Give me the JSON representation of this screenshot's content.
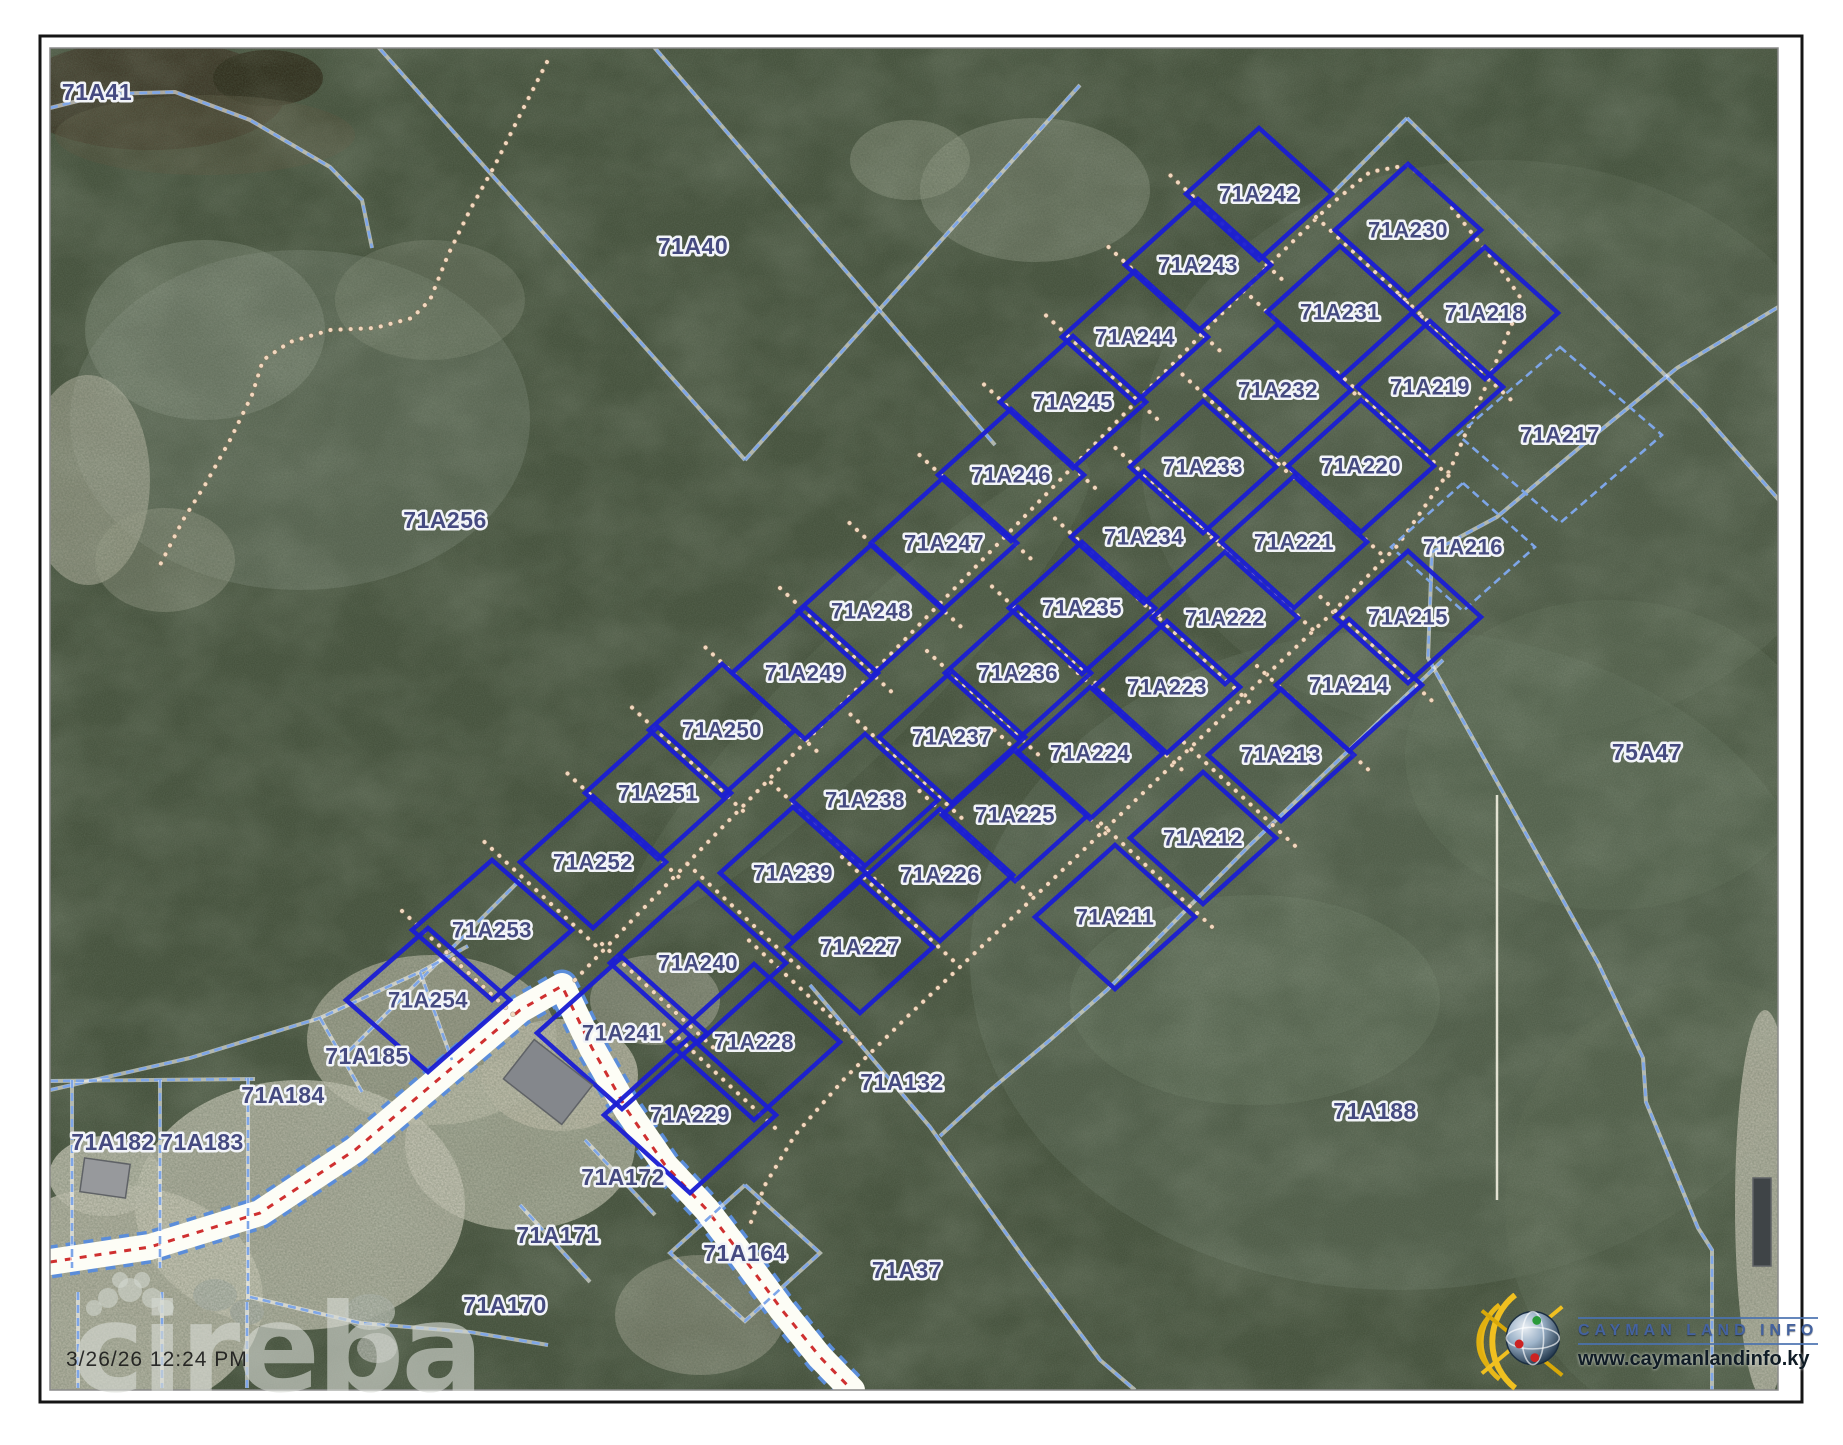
{
  "document": {
    "type": "cadastral-parcel-map-print",
    "timestamp": "3/26/26 12:24 PM",
    "watermark": "cireba",
    "logo": {
      "title": "CAYMAN LAND INFO",
      "url": "www.caymanlandinfo.ky"
    }
  },
  "colors": {
    "parcel_bold": "#1b1ed2",
    "parcel_light": "#7ea6e8",
    "label": "#454a80",
    "label_halo": "#f2f4f8",
    "trail_dots": "#f2d8bf",
    "trail_shadow": "#8a7258",
    "road_white": "#fdfdf6",
    "road_center_red": "#cf3030",
    "veg_base": "#45513c",
    "frame_dark": "#151515",
    "frame_gray": "#8a8a8a"
  },
  "frame": {
    "outer": [
      40,
      36,
      1762,
      1366
    ],
    "map": [
      50,
      48,
      1728,
      1342
    ]
  },
  "lot_geometry": {
    "half_w": 73,
    "half_h": 66
  },
  "lots_bold": [
    {
      "id": "71A242",
      "x": 1259,
      "y": 194
    },
    {
      "id": "71A243",
      "x": 1198,
      "y": 265
    },
    {
      "id": "71A244",
      "x": 1135,
      "y": 337
    },
    {
      "id": "71A245",
      "x": 1073,
      "y": 402
    },
    {
      "id": "71A246",
      "x": 1011,
      "y": 475
    },
    {
      "id": "71A247",
      "x": 944,
      "y": 543
    },
    {
      "id": "71A248",
      "x": 871,
      "y": 611
    },
    {
      "id": "71A249",
      "x": 805,
      "y": 673
    },
    {
      "id": "71A250",
      "x": 722,
      "y": 730
    },
    {
      "id": "71A251",
      "x": 658,
      "y": 793
    },
    {
      "id": "71A252",
      "x": 593,
      "y": 862
    },
    {
      "id": "71A253",
      "x": 492,
      "y": 930,
      "dh": 80,
      "dv": 70
    },
    {
      "id": "71A254",
      "x": 428,
      "y": 1000,
      "dh": 82,
      "dv": 72
    },
    {
      "id": "71A230",
      "x": 1408,
      "y": 230
    },
    {
      "id": "71A231",
      "x": 1340,
      "y": 312
    },
    {
      "id": "71A232",
      "x": 1278,
      "y": 390
    },
    {
      "id": "71A233",
      "x": 1203,
      "y": 467
    },
    {
      "id": "71A234",
      "x": 1144,
      "y": 537
    },
    {
      "id": "71A235",
      "x": 1082,
      "y": 608
    },
    {
      "id": "71A236",
      "x": 1018,
      "y": 673
    },
    {
      "id": "71A237",
      "x": 952,
      "y": 737
    },
    {
      "id": "71A238",
      "x": 865,
      "y": 800
    },
    {
      "id": "71A239",
      "x": 793,
      "y": 873
    },
    {
      "id": "71A240",
      "x": 698,
      "y": 963,
      "dh": 88,
      "dv": 80
    },
    {
      "id": "71A241",
      "x": 622,
      "y": 1033,
      "dh": 85,
      "dv": 76
    },
    {
      "id": "71A218",
      "x": 1485,
      "y": 313
    },
    {
      "id": "71A219",
      "x": 1430,
      "y": 387
    },
    {
      "id": "71A220",
      "x": 1361,
      "y": 466
    },
    {
      "id": "71A221",
      "x": 1294,
      "y": 542
    },
    {
      "id": "71A222",
      "x": 1225,
      "y": 618
    },
    {
      "id": "71A223",
      "x": 1167,
      "y": 687
    },
    {
      "id": "71A224",
      "x": 1090,
      "y": 753
    },
    {
      "id": "71A225",
      "x": 1015,
      "y": 815
    },
    {
      "id": "71A226",
      "x": 940,
      "y": 875
    },
    {
      "id": "71A227",
      "x": 860,
      "y": 947
    },
    {
      "id": "71A228",
      "x": 754,
      "y": 1042,
      "dh": 86,
      "dv": 78
    },
    {
      "id": "71A229",
      "x": 690,
      "y": 1115,
      "dh": 86,
      "dv": 78
    },
    {
      "id": "71A211",
      "x": 1115,
      "y": 917,
      "dh": 80,
      "dv": 72
    },
    {
      "id": "71A212",
      "x": 1203,
      "y": 838
    },
    {
      "id": "71A213",
      "x": 1281,
      "y": 755
    },
    {
      "id": "71A214",
      "x": 1349,
      "y": 685
    },
    {
      "id": "71A215",
      "x": 1408,
      "y": 617
    }
  ],
  "lots_light": [
    {
      "id": "71A216",
      "x": 1463,
      "y": 547,
      "dh": 72,
      "dv": 64
    },
    {
      "id": "71A217",
      "x": 1560,
      "y": 435,
      "dh": 102,
      "dv": 88
    }
  ],
  "columns": [
    [
      "71A242",
      "71A243",
      "71A244",
      "71A245",
      "71A246",
      "71A247",
      "71A248",
      "71A249",
      "71A250",
      "71A251",
      "71A252",
      "71A253",
      "71A254"
    ],
    [
      "71A230",
      "71A231",
      "71A232",
      "71A233",
      "71A234",
      "71A235",
      "71A236",
      "71A237",
      "71A238",
      "71A239",
      "71A240",
      "71A241"
    ],
    [
      "71A218",
      "71A219",
      "71A220",
      "71A221",
      "71A222",
      "71A223",
      "71A224",
      "71A225",
      "71A226",
      "71A227",
      "71A228",
      "71A229"
    ],
    [
      "71A211",
      "71A212",
      "71A213",
      "71A214",
      "71A215"
    ]
  ],
  "area_labels": [
    {
      "text": "71A41",
      "x": 97,
      "y": 92
    },
    {
      "text": "71A40",
      "x": 693,
      "y": 246
    },
    {
      "text": "71A256",
      "x": 445,
      "y": 520
    },
    {
      "text": "75A47",
      "x": 1647,
      "y": 752
    },
    {
      "text": "71A188",
      "x": 1375,
      "y": 1111
    },
    {
      "text": "71A132",
      "x": 902,
      "y": 1082
    },
    {
      "text": "71A37",
      "x": 907,
      "y": 1270
    },
    {
      "text": "71A164",
      "x": 745,
      "y": 1253
    },
    {
      "text": "71A172",
      "x": 623,
      "y": 1177
    },
    {
      "text": "71A171",
      "x": 558,
      "y": 1235
    },
    {
      "text": "71A170",
      "x": 505,
      "y": 1305
    },
    {
      "text": "71A185",
      "x": 367,
      "y": 1056
    },
    {
      "text": "71A184",
      "x": 283,
      "y": 1095
    },
    {
      "text": "71A183",
      "x": 202,
      "y": 1142
    },
    {
      "text": "71A182",
      "x": 113,
      "y": 1142
    }
  ],
  "cadastral_lines": [
    {
      "name": "pond-shore",
      "pts": [
        [
          50,
          108
        ],
        [
          105,
          94
        ],
        [
          175,
          92
        ],
        [
          250,
          120
        ],
        [
          330,
          167
        ],
        [
          362,
          200
        ],
        [
          372,
          248
        ]
      ]
    },
    {
      "name": "parcel40-west",
      "pts": [
        [
          372,
          40
        ],
        [
          745,
          460
        ]
      ]
    },
    {
      "name": "parcel40-south",
      "pts": [
        [
          745,
          460
        ],
        [
          1080,
          85
        ]
      ]
    },
    {
      "name": "parcel40-east",
      "pts": [
        [
          648,
          40
        ],
        [
          995,
          445
        ]
      ]
    },
    {
      "name": "block-northwest",
      "pts": [
        [
          340,
          1060
        ],
        [
          520,
          880
        ]
      ]
    },
    {
      "name": "block-peak-left",
      "pts": [
        [
          1407,
          118
        ],
        [
          1330,
          196
        ]
      ]
    },
    {
      "name": "block-peak-right",
      "pts": [
        [
          1407,
          118
        ],
        [
          1513,
          223
        ],
        [
          1610,
          320
        ],
        [
          1700,
          410
        ],
        [
          1843,
          573
        ]
      ]
    },
    {
      "name": "east-boundary",
      "pts": [
        [
          1843,
          268
        ],
        [
          1677,
          368
        ],
        [
          1585,
          443
        ],
        [
          1497,
          517
        ],
        [
          1432,
          552
        ],
        [
          1428,
          658
        ],
        [
          1598,
          963
        ],
        [
          1643,
          1058
        ],
        [
          1646,
          1102
        ],
        [
          1698,
          1228
        ],
        [
          1712,
          1250
        ],
        [
          1712,
          1390
        ]
      ]
    },
    {
      "name": "block-southeast",
      "pts": [
        [
          1443,
          660
        ],
        [
          1250,
          845
        ],
        [
          1107,
          990
        ],
        [
          1050,
          1040
        ],
        [
          988,
          1092
        ],
        [
          940,
          1136
        ]
      ]
    },
    {
      "name": "road-corridor-ne",
      "pts": [
        [
          810,
          985
        ],
        [
          930,
          1127
        ],
        [
          1023,
          1257
        ],
        [
          1100,
          1360
        ],
        [
          1135,
          1390
        ]
      ]
    },
    {
      "name": "p184-top",
      "pts": [
        [
          50,
          1090
        ],
        [
          190,
          1058
        ],
        [
          320,
          1018
        ],
        [
          420,
          972
        ],
        [
          468,
          946
        ]
      ]
    },
    {
      "name": "p182-top",
      "pts": [
        [
          50,
          1081
        ],
        [
          255,
          1079
        ]
      ]
    },
    {
      "name": "tick-182a",
      "pts": [
        [
          72,
          1080
        ],
        [
          72,
          1268
        ]
      ]
    },
    {
      "name": "tick-182b",
      "pts": [
        [
          160,
          1080
        ],
        [
          160,
          1268
        ]
      ]
    },
    {
      "name": "tick-183",
      "pts": [
        [
          248,
          1078
        ],
        [
          248,
          1300
        ]
      ]
    },
    {
      "name": "tick-184",
      "pts": [
        [
          320,
          1018
        ],
        [
          362,
          1092
        ]
      ]
    },
    {
      "name": "tick-185",
      "pts": [
        [
          420,
          972
        ],
        [
          452,
          1060
        ]
      ]
    },
    {
      "name": "under-road-1",
      "pts": [
        [
          78,
          1292
        ],
        [
          78,
          1388
        ]
      ]
    },
    {
      "name": "under-road-2",
      "pts": [
        [
          162,
          1292
        ],
        [
          162,
          1388
        ]
      ]
    },
    {
      "name": "under-road-3",
      "pts": [
        [
          247,
          1302
        ],
        [
          247,
          1388
        ]
      ]
    },
    {
      "name": "under-road-4",
      "pts": [
        [
          250,
          1297
        ],
        [
          360,
          1323
        ],
        [
          470,
          1332
        ],
        [
          548,
          1345
        ]
      ]
    },
    {
      "name": "tick-171",
      "pts": [
        [
          585,
          1140
        ],
        [
          655,
          1215
        ]
      ]
    },
    {
      "name": "tick-170",
      "pts": [
        [
          520,
          1205
        ],
        [
          590,
          1282
        ]
      ]
    },
    {
      "name": "lot164-boundary",
      "pts": [
        [
          745,
          1185
        ],
        [
          820,
          1253
        ],
        [
          745,
          1321
        ],
        [
          670,
          1253
        ],
        [
          745,
          1185
        ]
      ]
    }
  ],
  "trails": [
    {
      "name": "northwest-trail",
      "pts": [
        [
          547,
          62
        ],
        [
          520,
          115
        ],
        [
          495,
          165
        ],
        [
          470,
          210
        ],
        [
          448,
          255
        ],
        [
          430,
          300
        ],
        [
          412,
          318
        ],
        [
          375,
          328
        ],
        [
          330,
          330
        ],
        [
          290,
          342
        ],
        [
          263,
          360
        ],
        [
          252,
          395
        ],
        [
          230,
          440
        ],
        [
          205,
          485
        ],
        [
          183,
          520
        ],
        [
          160,
          565
        ]
      ]
    },
    {
      "name": "central-road",
      "pts": [
        [
          575,
          980
        ],
        [
          640,
          912
        ],
        [
          710,
          840
        ],
        [
          780,
          768
        ],
        [
          850,
          696
        ],
        [
          920,
          624
        ],
        [
          990,
          552
        ],
        [
          1060,
          480
        ],
        [
          1130,
          408
        ],
        [
          1200,
          336
        ],
        [
          1270,
          264
        ],
        [
          1330,
          205
        ],
        [
          1370,
          172
        ],
        [
          1408,
          165
        ],
        [
          1438,
          190
        ]
      ]
    },
    {
      "name": "southeast-road",
      "pts": [
        [
          1452,
          208
        ],
        [
          1505,
          275
        ],
        [
          1522,
          300
        ],
        [
          1480,
          400
        ],
        [
          1450,
          470
        ],
        [
          1398,
          545
        ],
        [
          1330,
          615
        ],
        [
          1258,
          683
        ],
        [
          1188,
          750
        ],
        [
          1118,
          817
        ],
        [
          1048,
          884
        ],
        [
          978,
          950
        ],
        [
          908,
          1016
        ],
        [
          845,
          1078
        ],
        [
          795,
          1135
        ],
        [
          765,
          1185
        ],
        [
          748,
          1230
        ]
      ]
    }
  ],
  "white_road": {
    "pts": [
      [
        50,
        1262
      ],
      [
        150,
        1247
      ],
      [
        260,
        1213
      ],
      [
        355,
        1150
      ],
      [
        440,
        1078
      ],
      [
        520,
        1010
      ],
      [
        562,
        986
      ],
      [
        592,
        1048
      ],
      [
        627,
        1110
      ],
      [
        665,
        1165
      ],
      [
        707,
        1210
      ],
      [
        743,
        1257
      ],
      [
        782,
        1310
      ],
      [
        820,
        1357
      ],
      [
        852,
        1390
      ]
    ]
  },
  "survey_line": {
    "pts": [
      [
        1497,
        795
      ],
      [
        1497,
        1200
      ]
    ]
  },
  "terrain": [
    {
      "t": "e",
      "x": 150,
      "y": 95,
      "rx": 135,
      "ry": 55,
      "f": "#3b3424",
      "o": 1
    },
    {
      "t": "e",
      "x": 268,
      "y": 78,
      "rx": 55,
      "ry": 28,
      "f": "#2d2918",
      "o": 1
    },
    {
      "t": "e",
      "x": 205,
      "y": 135,
      "rx": 150,
      "ry": 40,
      "f": "#55503a",
      "o": 0.5
    },
    {
      "t": "e",
      "x": 300,
      "y": 420,
      "rx": 230,
      "ry": 170,
      "f": "#7e8a77",
      "o": 0.4
    },
    {
      "t": "e",
      "x": 205,
      "y": 330,
      "rx": 120,
      "ry": 90,
      "f": "#95a08d",
      "o": 0.38
    },
    {
      "t": "e",
      "x": 430,
      "y": 300,
      "rx": 95,
      "ry": 60,
      "f": "#8b9580",
      "o": 0.35
    },
    {
      "t": "e",
      "x": 88,
      "y": 480,
      "rx": 62,
      "ry": 105,
      "f": "#c7c2b0",
      "o": 0.55
    },
    {
      "t": "e",
      "x": 165,
      "y": 560,
      "rx": 70,
      "ry": 52,
      "f": "#a8ab97",
      "o": 0.4
    },
    {
      "t": "e",
      "x": 1035,
      "y": 190,
      "rx": 115,
      "ry": 72,
      "f": "#939c88",
      "o": 0.45
    },
    {
      "t": "e",
      "x": 910,
      "y": 160,
      "rx": 60,
      "ry": 40,
      "f": "#a2a994",
      "o": 0.4
    },
    {
      "t": "e",
      "x": 1600,
      "y": 150,
      "rx": 220,
      "ry": 120,
      "f": "#46543e",
      "o": 0.5
    },
    {
      "t": "e",
      "x": 1500,
      "y": 450,
      "rx": 360,
      "ry": 290,
      "f": "#5a6854",
      "o": 0.45
    },
    {
      "t": "e",
      "x": 1400,
      "y": 960,
      "rx": 430,
      "ry": 330,
      "f": "#5f6e59",
      "o": 0.5
    },
    {
      "t": "e",
      "x": 1705,
      "y": 1205,
      "rx": 200,
      "ry": 225,
      "f": "#57664f",
      "o": 0.5
    },
    {
      "t": "e",
      "x": 1255,
      "y": 1000,
      "rx": 185,
      "ry": 105,
      "f": "#6c7b64",
      "o": 0.4
    },
    {
      "t": "e",
      "x": 1610,
      "y": 755,
      "rx": 205,
      "ry": 155,
      "f": "#61705a",
      "o": 0.4
    },
    {
      "t": "e",
      "x": 860,
      "y": 690,
      "rx": 320,
      "ry": 60,
      "f": "#64735c",
      "o": 0.3,
      "rot": -45
    },
    {
      "t": "e",
      "x": 432,
      "y": 1040,
      "rx": 125,
      "ry": 85,
      "f": "#ccc7b5",
      "o": 0.65
    },
    {
      "t": "e",
      "x": 520,
      "y": 1145,
      "rx": 115,
      "ry": 85,
      "f": "#d2cebc",
      "o": 0.7
    },
    {
      "t": "e",
      "x": 300,
      "y": 1205,
      "rx": 165,
      "ry": 125,
      "f": "#d8d4c4",
      "o": 0.75
    },
    {
      "t": "e",
      "x": 118,
      "y": 1300,
      "rx": 145,
      "ry": 115,
      "f": "#d5d1c1",
      "o": 0.8
    },
    {
      "t": "e",
      "x": 655,
      "y": 1000,
      "rx": 65,
      "ry": 45,
      "f": "#c2bead",
      "o": 0.5
    },
    {
      "t": "e",
      "x": 700,
      "y": 1315,
      "rx": 85,
      "ry": 60,
      "f": "#b9b6a4",
      "o": 0.45
    },
    {
      "t": "e",
      "x": 1765,
      "y": 1205,
      "rx": 30,
      "ry": 195,
      "f": "#cfcaba",
      "o": 0.8
    },
    {
      "t": "e",
      "x": 560,
      "y": 1075,
      "rx": 78,
      "ry": 56,
      "f": "#c9c4b2",
      "o": 0.85
    },
    {
      "t": "e",
      "x": 105,
      "y": 1176,
      "rx": 56,
      "ry": 40,
      "f": "#cfccbc",
      "o": 0.85
    },
    {
      "t": "e",
      "x": 215,
      "y": 1295,
      "rx": 22,
      "ry": 16,
      "f": "#b9bcb4",
      "o": 0.9
    },
    {
      "t": "e",
      "x": 247,
      "y": 1312,
      "rx": 17,
      "ry": 13,
      "f": "#b3b6ae",
      "o": 0.9
    },
    {
      "t": "e",
      "x": 370,
      "y": 1312,
      "rx": 25,
      "ry": 18,
      "f": "#b9bcb4",
      "o": 0.9
    },
    {
      "t": "e",
      "x": 377,
      "y": 1348,
      "rx": 20,
      "ry": 15,
      "f": "#b0b3ab",
      "o": 0.9
    }
  ],
  "buildings": [
    {
      "x": 548,
      "y": 1082,
      "w": 74,
      "h": 50,
      "rot": 38,
      "f": "#84878c"
    },
    {
      "x": 105,
      "y": 1178,
      "w": 46,
      "h": 34,
      "rot": 8,
      "f": "#97999c"
    },
    {
      "x": 1762,
      "y": 1222,
      "w": 18,
      "h": 88,
      "rot": 0,
      "f": "#3f4447"
    }
  ]
}
